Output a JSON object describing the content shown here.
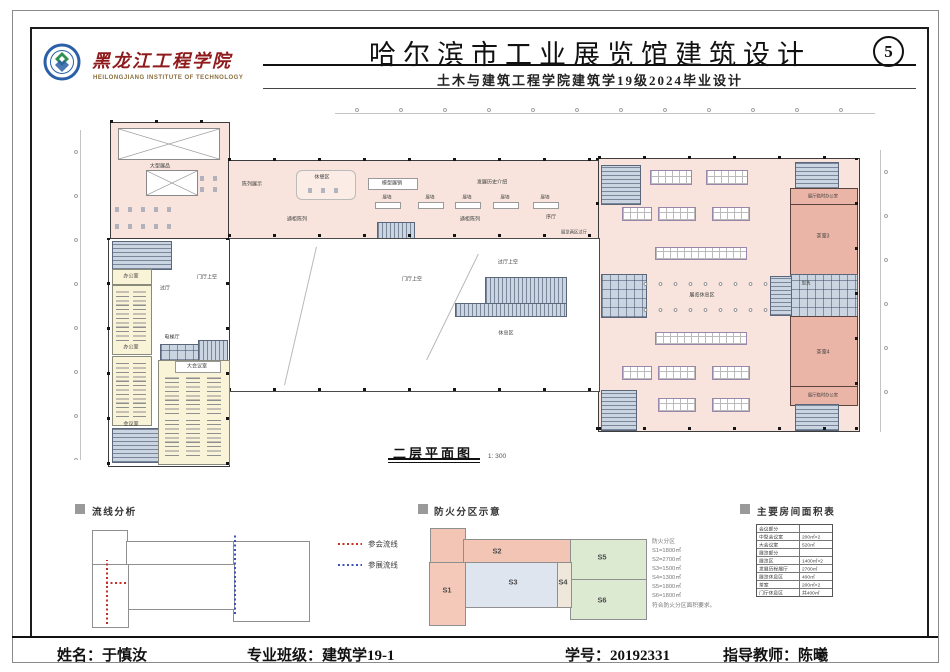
{
  "header": {
    "school_cn": "黑龙江工程学院",
    "school_en": "HEILONGJIANG  INSTITUTE  OF  TECHNOLOGY",
    "title": "哈尔滨市工业展览馆建筑设计",
    "subtitle": "土木与建筑工程学院建筑学19级2024毕业设计",
    "sheet_no": "5"
  },
  "plan": {
    "name": "二层平面图",
    "scale": "1: 300",
    "labels": {
      "large_exhibit": "大型展品",
      "display": "陈列展示",
      "rest_corner": "休憩区",
      "model_sale": "模型展销",
      "history": "发展历史介绍",
      "wall": "展墙",
      "case": "通柜陈列",
      "prelude": "序厅",
      "office": "办公室",
      "meeting": "会议室",
      "grand_meeting": "大会议室",
      "passage": "过厅",
      "passage_void": "过厅上空",
      "hall_void": "门厅上空",
      "rest_area": "休息区",
      "elevator_hall": "电梯厅",
      "exhibit_rest": "展览休息区",
      "zone2_hall": "展览两区过厅",
      "zone3_hall": "展览三区过厅",
      "temp_office": "展厅临时办公室",
      "tea3": "茶室3",
      "tea4": "茶室4",
      "wash": "盥洗"
    }
  },
  "circulation": {
    "title": "流线分析",
    "legend": [
      {
        "label": "参会流线",
        "color": "#c43025"
      },
      {
        "label": "参展流线",
        "color": "#3e52b5"
      }
    ]
  },
  "fire": {
    "title": "防火分区示意",
    "zones": [
      "S1",
      "S2",
      "S3",
      "S4",
      "S5",
      "S6"
    ],
    "notes": [
      "防火分区",
      "S1=1800㎡",
      "S2=2700㎡",
      "S3=1500㎡",
      "S4=1300㎡",
      "S5=1800㎡",
      "S6=1800㎡",
      "符合防火分区面积要求。"
    ]
  },
  "area_table": {
    "title": "主要房间面积表",
    "rows": [
      [
        "会议部分",
        ""
      ],
      [
        "中型会议室",
        "200㎡×2"
      ],
      [
        "大会议室",
        "520㎡"
      ],
      [
        "展览部分",
        ""
      ],
      [
        "展览区",
        "1400㎡×2"
      ],
      [
        "发展历程展厅",
        "2700㎡"
      ],
      [
        "展览休息区",
        "400㎡"
      ],
      [
        "茶室",
        "200㎡×2"
      ],
      [
        "门厅休息区",
        "共400㎡"
      ]
    ]
  },
  "footer": {
    "items": [
      {
        "label": "姓名：",
        "value": "于慎汝"
      },
      {
        "label": "专业班级：",
        "value": "建筑学19-1"
      },
      {
        "label": "学号：",
        "value": "20192331"
      },
      {
        "label": "指导教师：",
        "value": "陈曦"
      }
    ]
  },
  "colors": {
    "plan_pink": "#f8e4dd",
    "plan_dark_pink": "#eab5a7",
    "plan_yellow": "#f9f3d8",
    "core_grey": "#cbd5e1",
    "flow_red": "#c43025",
    "flow_blue": "#3e52b5",
    "fire_salmon": "#f2c5b5",
    "fire_green": "#dcead2",
    "fire_blue": "#dfe5ee",
    "school_red": "#8f1a1c"
  }
}
